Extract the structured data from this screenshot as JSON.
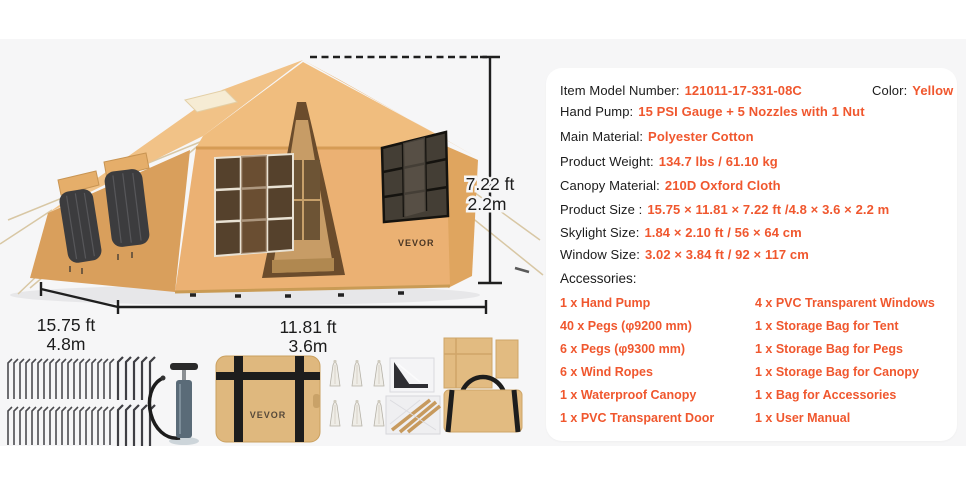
{
  "page": {
    "background": "#ffffff",
    "stage_background": "#f6f6f7",
    "accent_color": "#F0572E",
    "text_color": "#1b1b1b",
    "tent_color": "#EBB173"
  },
  "tent": {
    "logo": "VEVOR"
  },
  "dimensions": {
    "height_ft": "7.22 ft",
    "height_m": "2.2m",
    "depth_ft": "15.75 ft",
    "depth_m": "4.8m",
    "width_ft": "11.81 ft",
    "width_m": "3.6m"
  },
  "panel": {
    "row1": {
      "label1": "Item Model Number:",
      "value1": "121011-17-331-08C",
      "label2": "Color:",
      "value2": "Yellow"
    },
    "specs": [
      {
        "label": "Hand Pump:",
        "value": "15 PSI Gauge + 5 Nozzles with 1 Nut"
      },
      {
        "label": "Main Material:",
        "value": "Polyester Cotton"
      },
      {
        "label": "Product Weight:",
        "value": "134.7 lbs / 61.10 kg"
      },
      {
        "label": "Canopy Material:",
        "value": "210D Oxford Cloth"
      },
      {
        "label": "Product Size :",
        "value": "15.75 × 11.81 × 7.22 ft /4.8 × 3.6 × 2.2 m"
      },
      {
        "label": "Skylight Size:",
        "value": "1.84 × 2.10 ft / 56 × 64 cm"
      },
      {
        "label": "Window Size:",
        "value": "3.02 × 3.84 ft / 92 × 117 cm"
      }
    ],
    "accessories_heading": "Accessories:",
    "accessories_col1": [
      "1 x Hand Pump",
      "40 x Pegs (φ9200 mm)",
      "6 x Pegs (φ9300 mm)",
      "6 x Wind Ropes",
      "1 x Waterproof Canopy",
      "1 x PVC Transparent Door"
    ],
    "accessories_col2": [
      "4 x PVC Transparent Windows",
      "1 x Storage Bag for Tent",
      "1 x Storage Bag for Pegs",
      "1 x Storage Bag for Canopy",
      "1 x Bag for Accessories",
      "1 x User Manual"
    ]
  },
  "accessories_photo": {
    "bag_logo": "VEVOR"
  }
}
